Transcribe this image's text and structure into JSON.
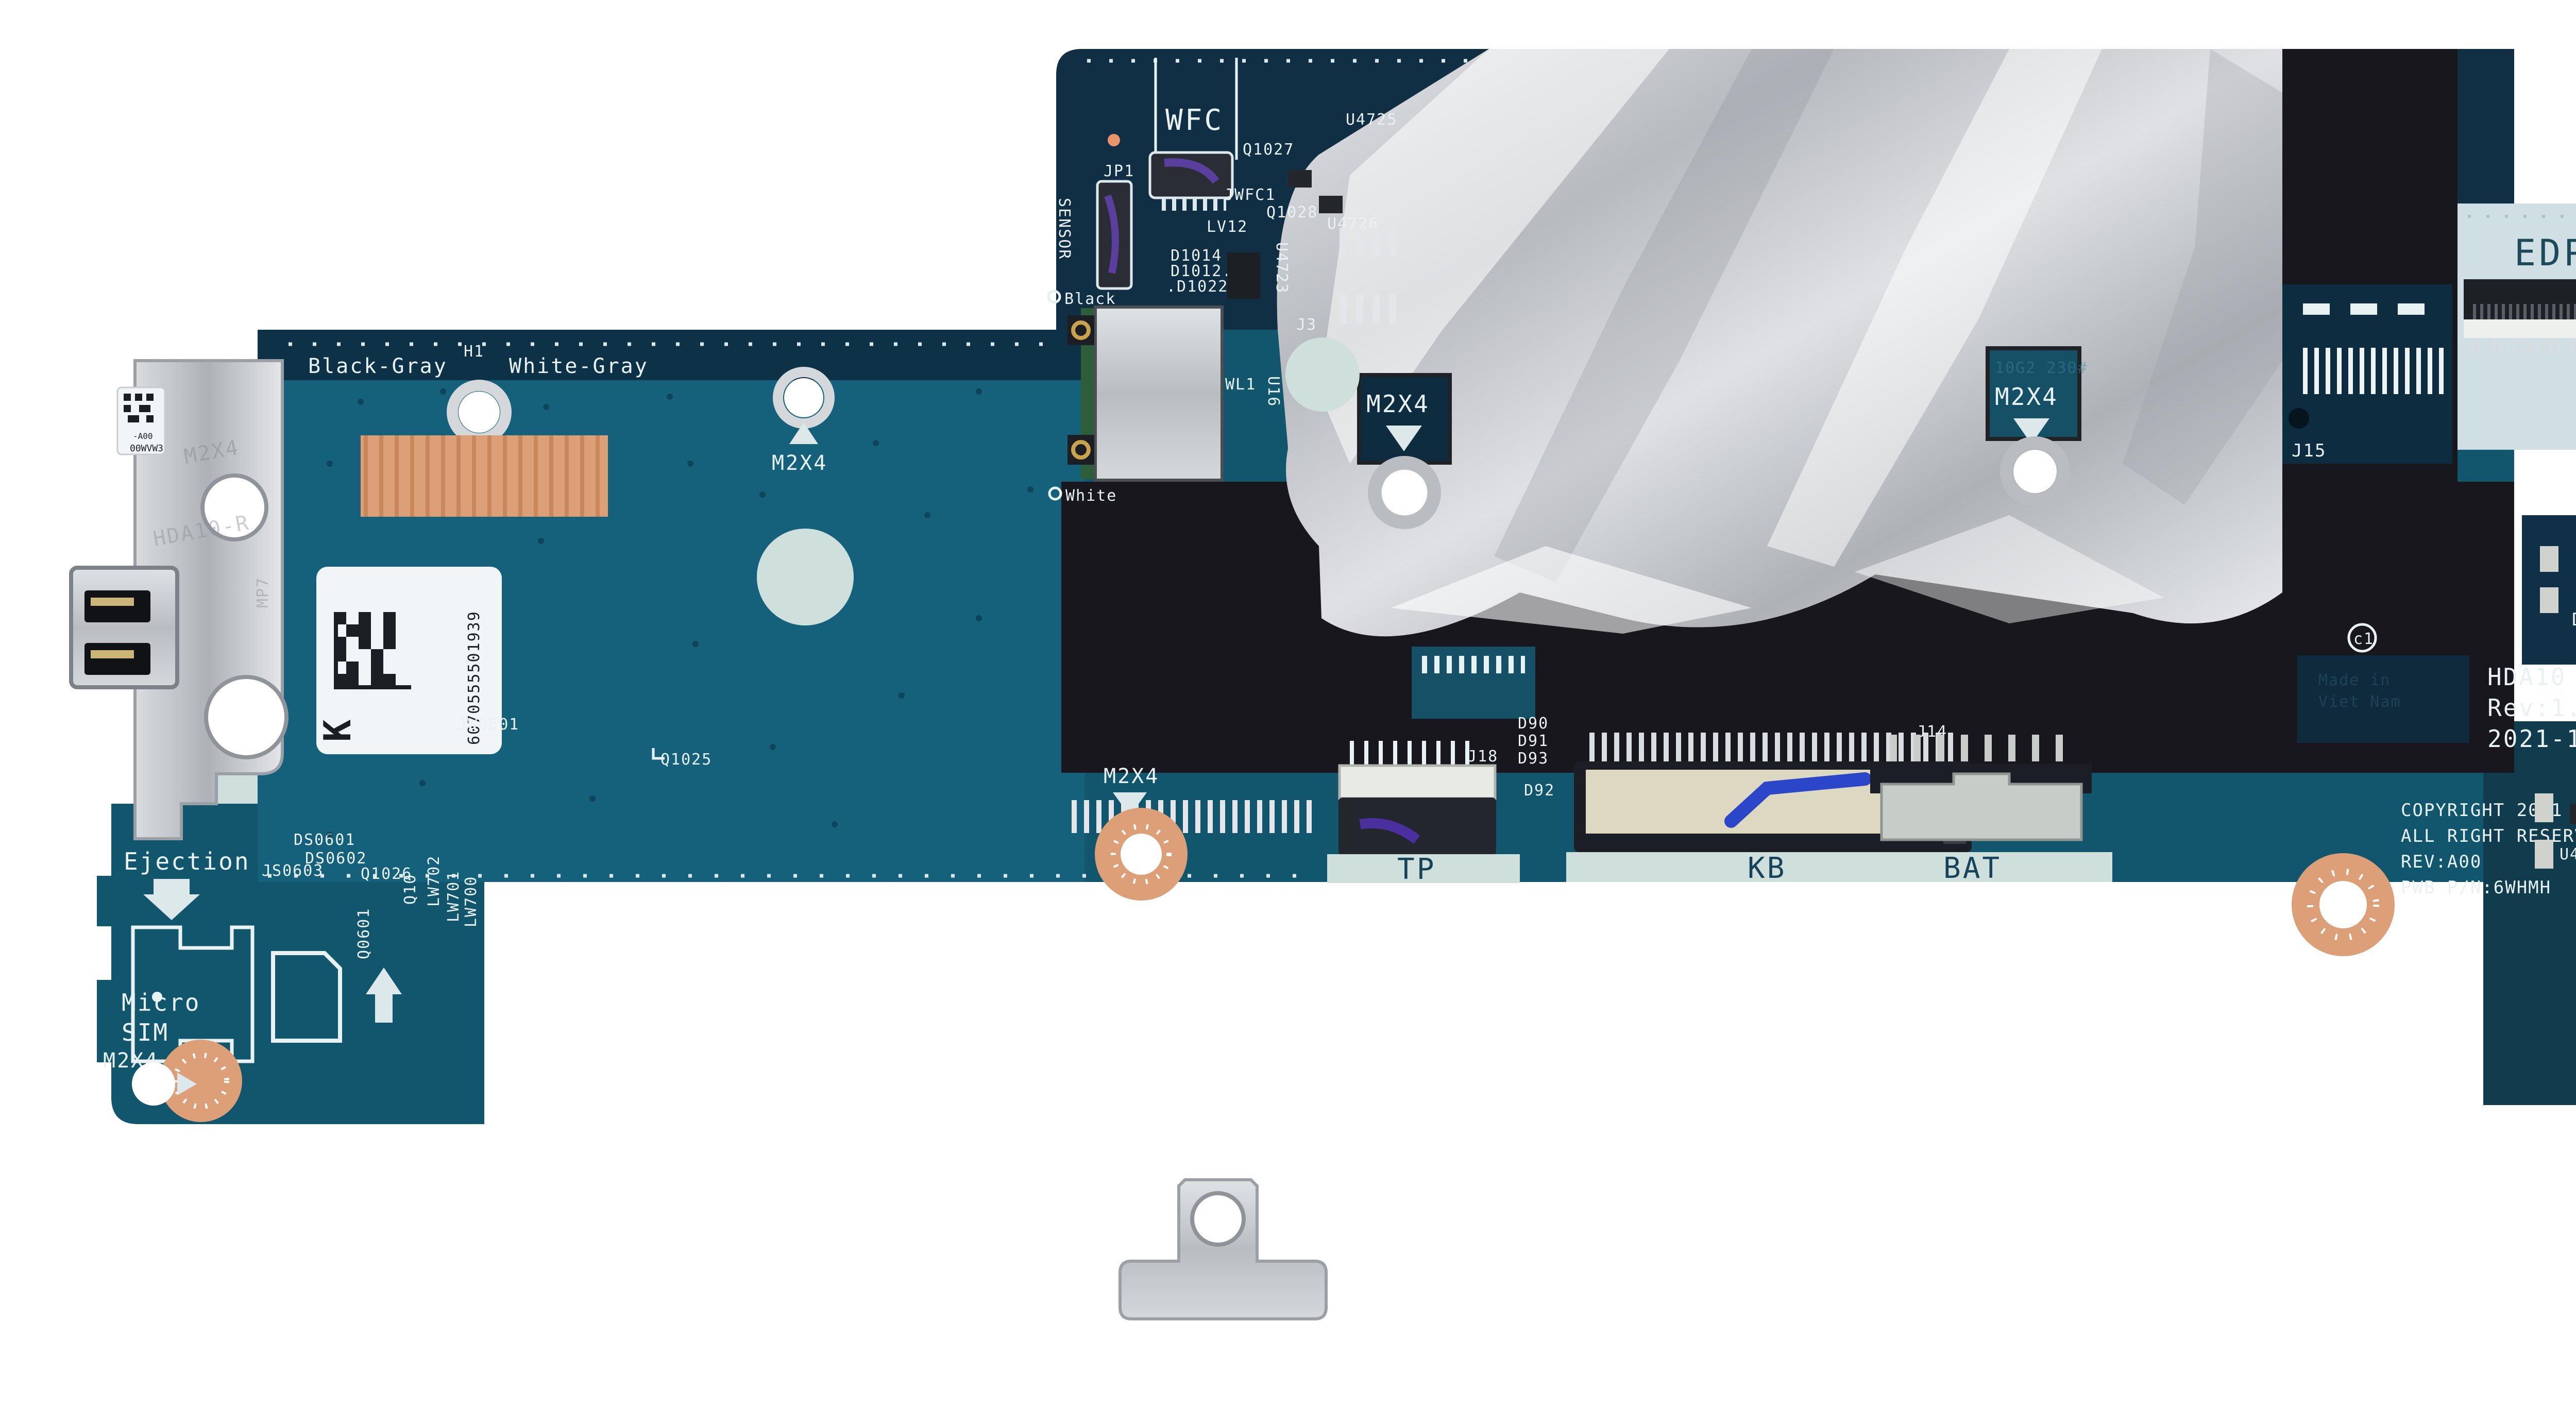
{
  "photo": {
    "description": "laptop motherboard product photo",
    "background": "#ffffff"
  },
  "colors": {
    "teal_board": "#12566d",
    "teal_light": "#15607a",
    "navy_board": "#102e44",
    "black_cover": "#17171d",
    "foil_silver": "#c4c7cb",
    "light_pcb": "#cfdfe3",
    "copper_pad": "#dd9f78",
    "silkscreen_white": "#e9f2f2",
    "silkscreen_dark": "#16435a",
    "marker_blue": "#2b46c8"
  },
  "top_section": {
    "wfc": "WFC",
    "jp1": "JP1",
    "sensor": "SENSOR",
    "q1027": "Q1027",
    "u4725": "U4725",
    "jwfc1": "JWFC1",
    "q1028": "Q1028",
    "lv12": "LV12",
    "u4726": "U4726",
    "d1014": "D1014",
    "d1012": "D1012.",
    "d1022": ".D1022",
    "u4723": "U4723",
    "j3": "J3",
    "wl1": "WL1",
    "u16": "U16",
    "black_ant": "Black",
    "white_ant": "White"
  },
  "left_section": {
    "black_gray": "Black-Gray",
    "h1": "H1",
    "white_gray": "White-Gray",
    "m2x4_top": "M2X4",
    "m2x4_mid": "M2X4",
    "barcode_number": "6070555501939",
    "barcode_letter": "K",
    "jw0601": "JW0601",
    "q1025": "Q1025"
  },
  "bracket": {
    "sticker_line1": "00WVW3",
    "sticker_line2": "-A00",
    "embossed_m2x4": "M2X4",
    "embossed_model": "HDA10-R",
    "embossed_mp7": "MP7"
  },
  "bottom_left": {
    "ejection": "Ejection",
    "js0603": "JS0603",
    "ds0601": "DS0601",
    "ds0602": "DS0602",
    "q1026": "Q1026",
    "q10": "Q10",
    "lw702": "LW702",
    "lw701": "LW701",
    "lw700": "LW700",
    "q0601": "Q0601",
    "micro": "Micro",
    "sim": "SIM",
    "m2x4": "M2X4"
  },
  "connectors": {
    "tp_label": "TP",
    "kb_label": "KB",
    "bat_label": "BAT",
    "j18": "J18",
    "j14": "J14",
    "d90": "D90",
    "d91": "D91",
    "d93": "D93",
    "d92": "D92"
  },
  "foil_area": {
    "m2x4_left": "M2X4",
    "m2x4_right": "M2X4",
    "faint_code": "10G2 230#"
  },
  "right_section": {
    "edp": "EDP",
    "j15": "J15",
    "q100": "Q100",
    "d100": "D100",
    "u2": "U2",
    "u4": "U4",
    "c1": "c1",
    "pb": "Pb",
    "part_line1": "HDA10 LA-L564P",
    "part_line2": "Rev:1.0(A00)",
    "part_line3": "2021-11-23",
    "copyright_line1": "COPYRIGHT 2021",
    "copyright_line2": "ALL RIGHT RESERVED",
    "copyright_line3": "REV:A00",
    "copyright_line4": "PWB P/N:6WHMH",
    "service_label_line1": "Made in",
    "service_label_line2": "Viet Nam",
    "j4": "J4",
    "d1010": "D1010",
    "speaker": "SPEAKER",
    "d12": "D12",
    "l27206": "L27206.",
    "d15": "D15",
    "h31": "H31",
    "h30": "H30",
    "m2x4_copper": "M2X4",
    "wp_screw": "WP SCREW",
    "m2x4_wp": "M2X4"
  }
}
